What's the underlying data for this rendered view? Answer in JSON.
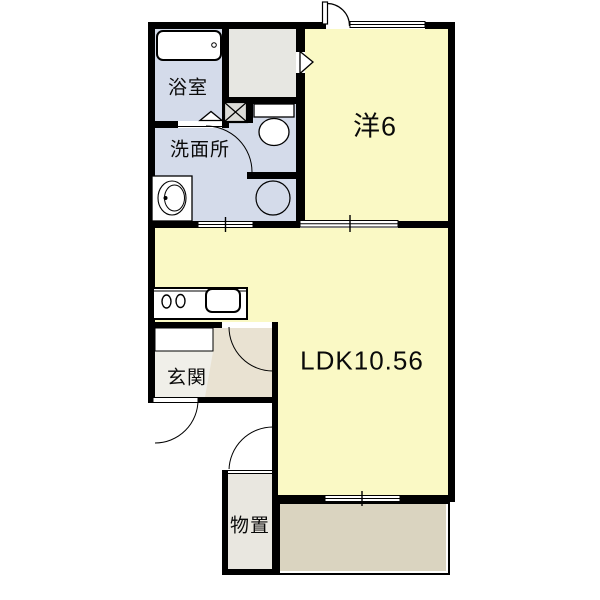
{
  "floorplan": {
    "rooms": {
      "bathroom": {
        "label": "浴室"
      },
      "washroom": {
        "label": "洗面所"
      },
      "western": {
        "label": "洋6"
      },
      "ldk": {
        "label": "LDK10.56"
      },
      "entrance": {
        "label": "玄関"
      },
      "storage": {
        "label": "物置"
      }
    },
    "fixtures": [
      "bathtub",
      "toilet",
      "washbasin",
      "washing-machine-space",
      "pipe-space",
      "kitchen-counter",
      "stove-burners",
      "kitchen-sink",
      "shoe-cabinet",
      "closet",
      "balcony",
      "entry-door",
      "sliding-doors",
      "windows"
    ],
    "colors": {
      "room_yellow": "#FAF9C5",
      "wet_area_blue": "#D4DBEA",
      "closet_gray": "#E7E7E2",
      "pipe_space_gray": "#DBDBD7",
      "entrance_hall": "#F0EFE9",
      "entrance_tataki": "#E9E2D2",
      "storage_gray": "#E9E7E0",
      "balcony_tan": "#DAD4C0",
      "wall_black": "#000000"
    }
  }
}
